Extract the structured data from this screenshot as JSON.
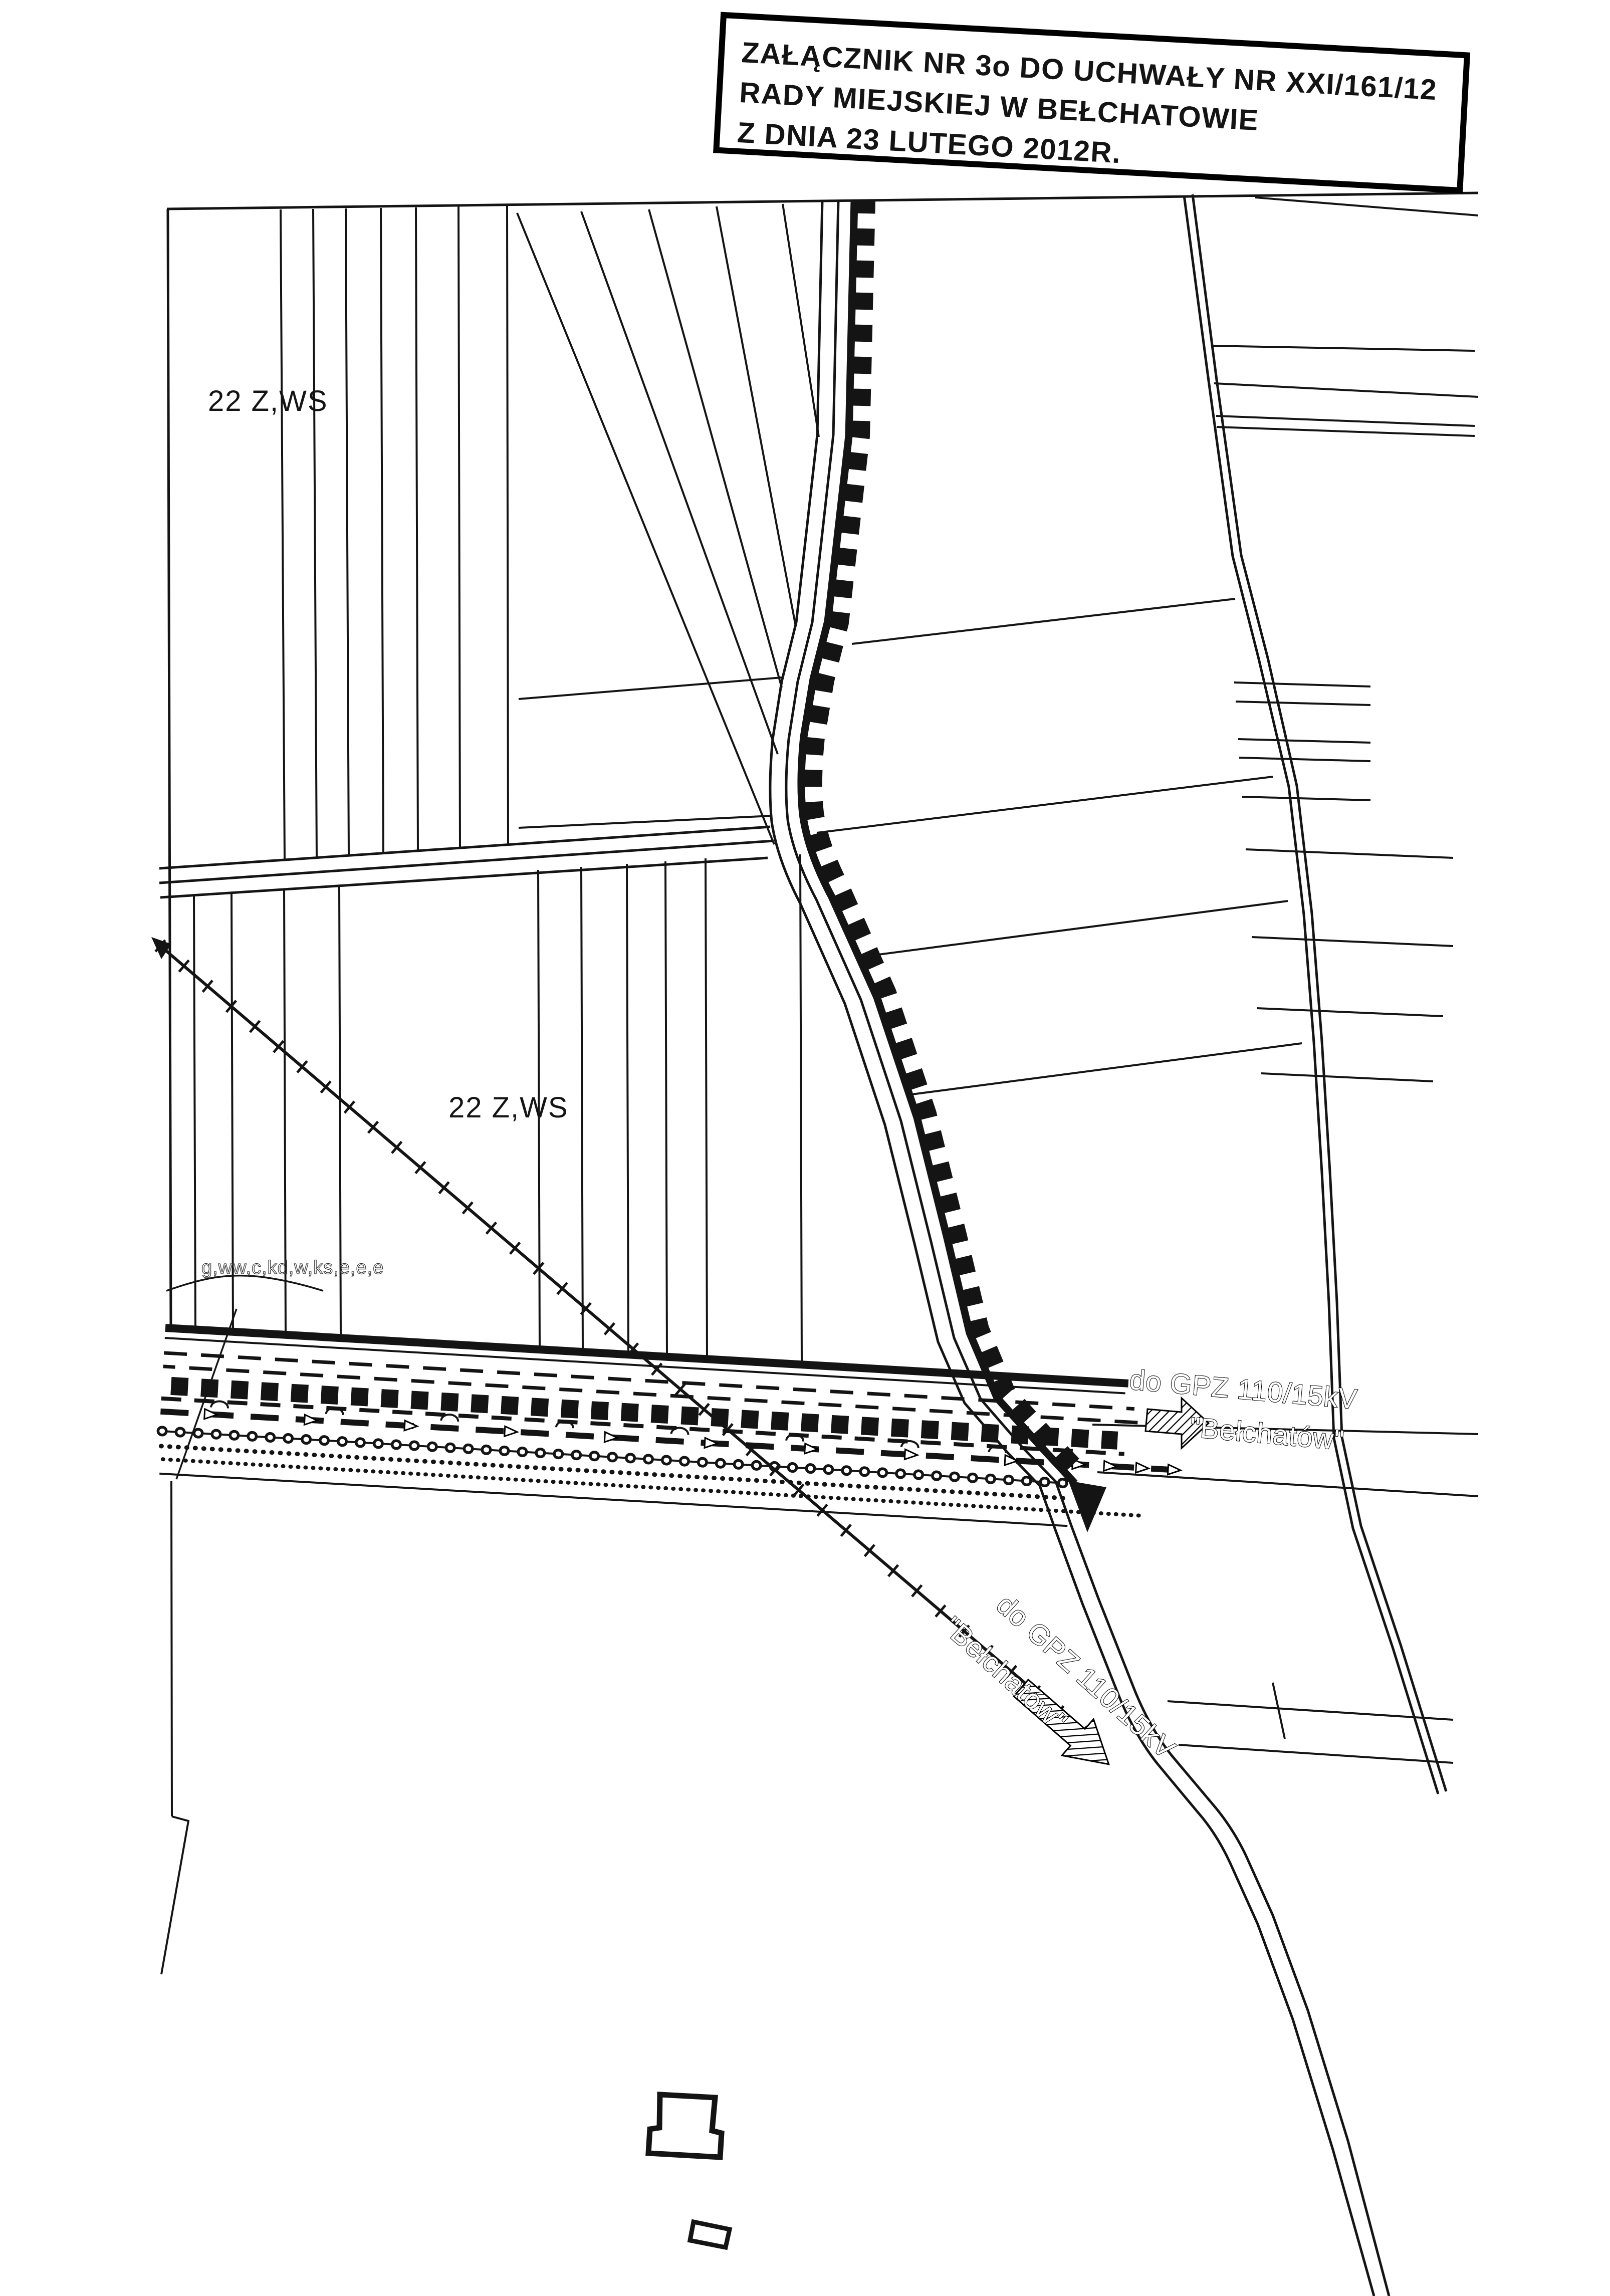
{
  "stamp": {
    "line1": "ZAŁĄCZNIK NR 3o DO UCHWAŁY NR XXI/161/12",
    "line2": "RADY MIEJSKIEJ W BEŁCHATOWIE",
    "line3": "Z DNIA 23 LUTEGO 2012R."
  },
  "labels": {
    "zone_top": "22 Z,WS",
    "zone_mid": "22 Z,WS",
    "utilities": "g,ww,c,kd,w,ks,e,e,e",
    "gpz_right": {
      "line1": "do GPZ 110/15kV",
      "line2": "\"Bełchatów\""
    },
    "gpz_diag": {
      "line1": "do GPZ 110/15kV",
      "line2": "\"Bełchatów\""
    }
  },
  "colors": {
    "ink": "#141414",
    "paper": "#ffffff"
  }
}
